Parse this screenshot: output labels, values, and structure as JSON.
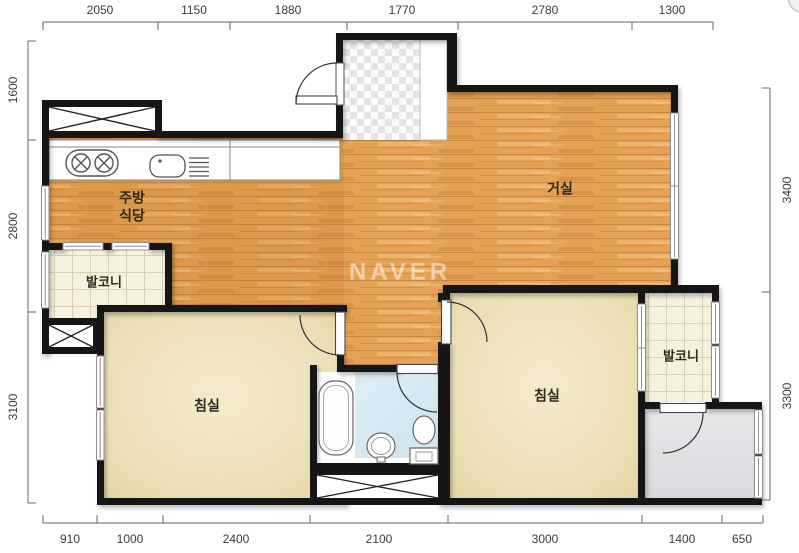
{
  "watermark": "NAVER",
  "rooms": {
    "kitchen_line1": "주방",
    "kitchen_line2": "식당",
    "living": "거실",
    "balcony_left": "발코니",
    "balcony_right": "발코니",
    "bedroom_left": "침실",
    "bedroom_right": "침실"
  },
  "dimensions": {
    "top": [
      "2050",
      "1150",
      "1880",
      "1770",
      "2780",
      "1300"
    ],
    "left": [
      "1600",
      "2800",
      "3100"
    ],
    "right": [
      "3400",
      "3300"
    ],
    "bottom": [
      "910",
      "1000",
      "2400",
      "2100",
      "3000",
      "1400",
      "650"
    ]
  },
  "colors": {
    "wall": "#161616",
    "wood_floor": "#E4A255",
    "bedroom_floor": "#EBDFB6",
    "balcony_floor": "#F7F0DE",
    "bathroom_floor": "#D9E9F2",
    "utility_floor": "#E0E1E4",
    "dimension_text": "#3B3B3B"
  }
}
